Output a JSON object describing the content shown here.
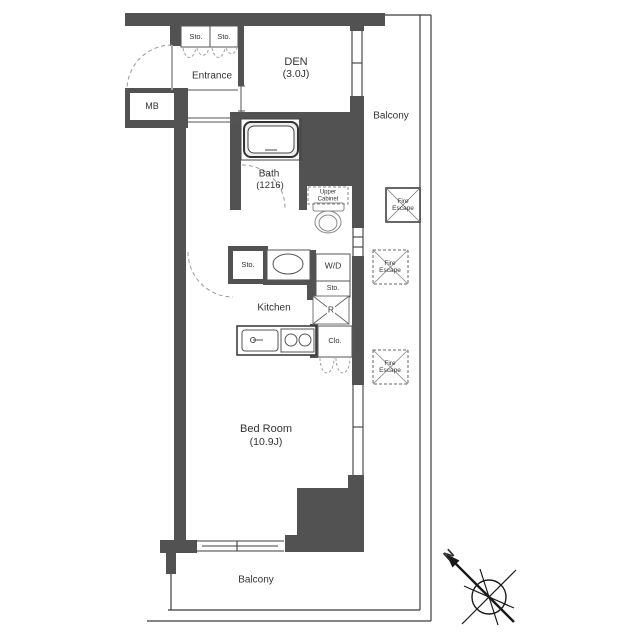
{
  "floorplan": {
    "rooms": {
      "entrance": "Entrance",
      "den_name": "DEN",
      "den_size": "(3.0J)",
      "bath_name": "Bath",
      "bath_size": "(1216)",
      "kitchen": "Kitchen",
      "bedroom_name": "Bed Room",
      "bedroom_size": "(10.9J)",
      "balcony_side": "Balcony",
      "balcony_bottom": "Balcony"
    },
    "fixtures": {
      "sto_entrance_left": "Sto.",
      "sto_entrance_right": "Sto.",
      "sto_hall": "Sto.",
      "mb": "MB",
      "wd": "W/D",
      "wd_sto": "Sto.",
      "refrigerator": "R",
      "closet": "Clo.",
      "upper_cabinet": "Upper Cabinet"
    },
    "annotations": {
      "fire_escape_top": "Fire Escape",
      "fire_escape_middle": "Fire Escape",
      "fire_escape_bottom": "Fire Escape",
      "compass_north": "N"
    },
    "colors": {
      "wall": "#525252",
      "outline": "#3c3c3c",
      "text": "#333333",
      "dashed": "#9a9a9a",
      "background": "#ffffff"
    }
  }
}
